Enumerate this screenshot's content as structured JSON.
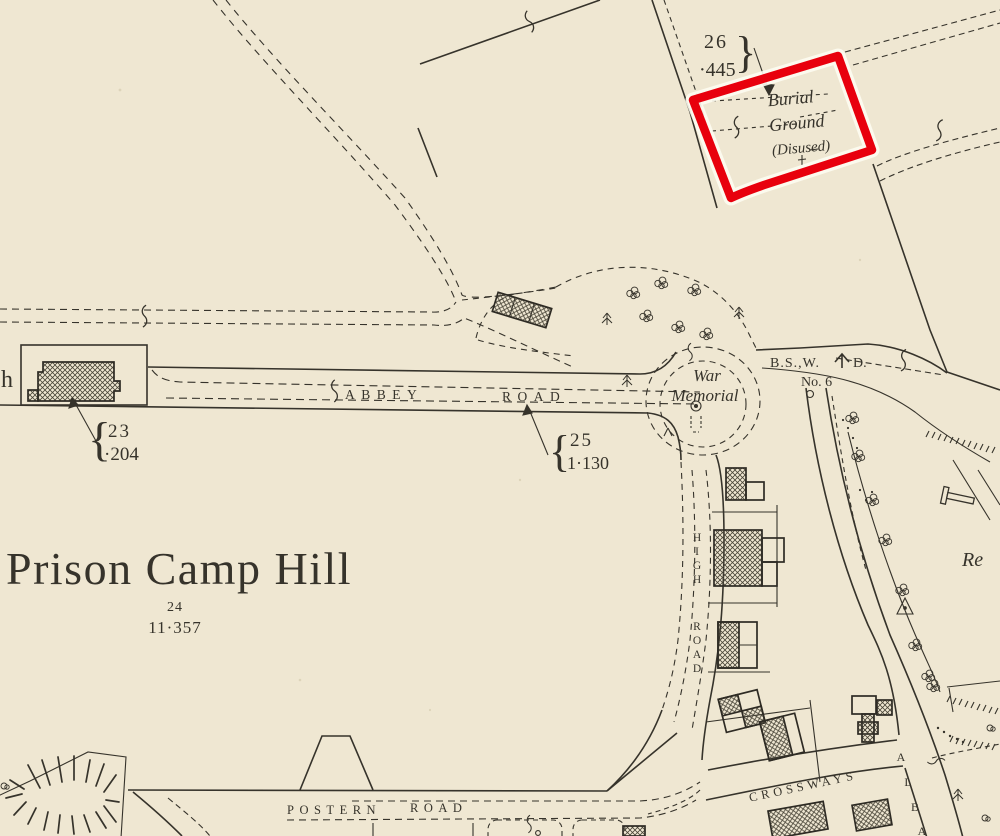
{
  "annotation": {
    "highlight_color": "#e8000d"
  },
  "palette": {
    "paper": "#efe7d2",
    "ink": "#36332b"
  },
  "map": {
    "features": {
      "edge": {
        "fragment": "h"
      },
      "burial": {
        "l1": "Burial",
        "l2": "Ground",
        "l3": "(Disused)"
      },
      "memorial": {
        "l1": "War",
        "l2": "Memorial"
      },
      "prison": {
        "label": "Prison Camp Hill"
      },
      "boundary_marker": {
        "p1": "B.S.,W.",
        "p2": "D.",
        "no": "No. 6"
      },
      "recreation": {
        "fragment": "Re"
      }
    },
    "parcels": {
      "p26": {
        "number": "26",
        "area": "·445",
        "brace": "}"
      },
      "p25": {
        "number": "25",
        "area": "1·130",
        "brace": "{"
      },
      "p23": {
        "number": "23",
        "area": "·204",
        "brace": "{"
      },
      "p24": {
        "number": "24",
        "area": "11·357"
      }
    },
    "roads": {
      "abbey": {
        "w1": "ABBEY",
        "w2": "ROAD"
      },
      "high": {
        "l": [
          "H",
          "I",
          "G",
          "H",
          "R",
          "O",
          "A",
          "D"
        ]
      },
      "postern": {
        "w1": "POSTERN",
        "w2": "ROAD"
      },
      "crossways": {
        "label": "CROSSWAYS"
      },
      "albany": {
        "l": [
          "A",
          "L",
          "B",
          "A"
        ]
      }
    }
  }
}
